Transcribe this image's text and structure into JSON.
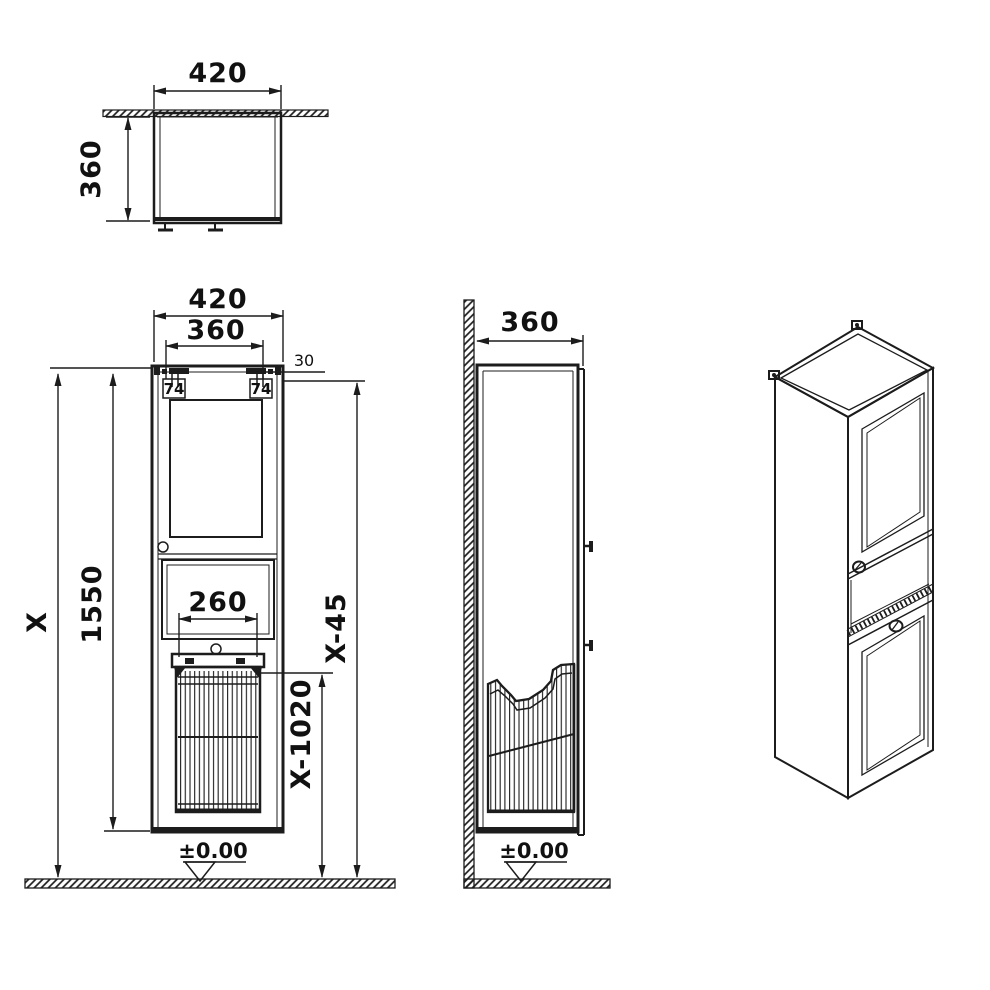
{
  "drawing": {
    "type": "technical-dimension-drawing",
    "subject": "tall wall-hung cabinet with laundry basket",
    "colors": {
      "line": "#1c1c1c",
      "background": "#ffffff"
    }
  },
  "top_view": {
    "width": "420",
    "depth": "360"
  },
  "front_view": {
    "width": "420",
    "hanger_spacing": "360",
    "hanger_offset": "30",
    "bracket_left": "74",
    "bracket_right": "74",
    "cabinet_height": "1550",
    "overall_height": "X",
    "basket_width": "260",
    "height_minus_45": "X-45",
    "height_minus_1020": "X-1020",
    "floor_level": "±0.00"
  },
  "side_view": {
    "depth": "360",
    "floor_level": "±0.00"
  }
}
